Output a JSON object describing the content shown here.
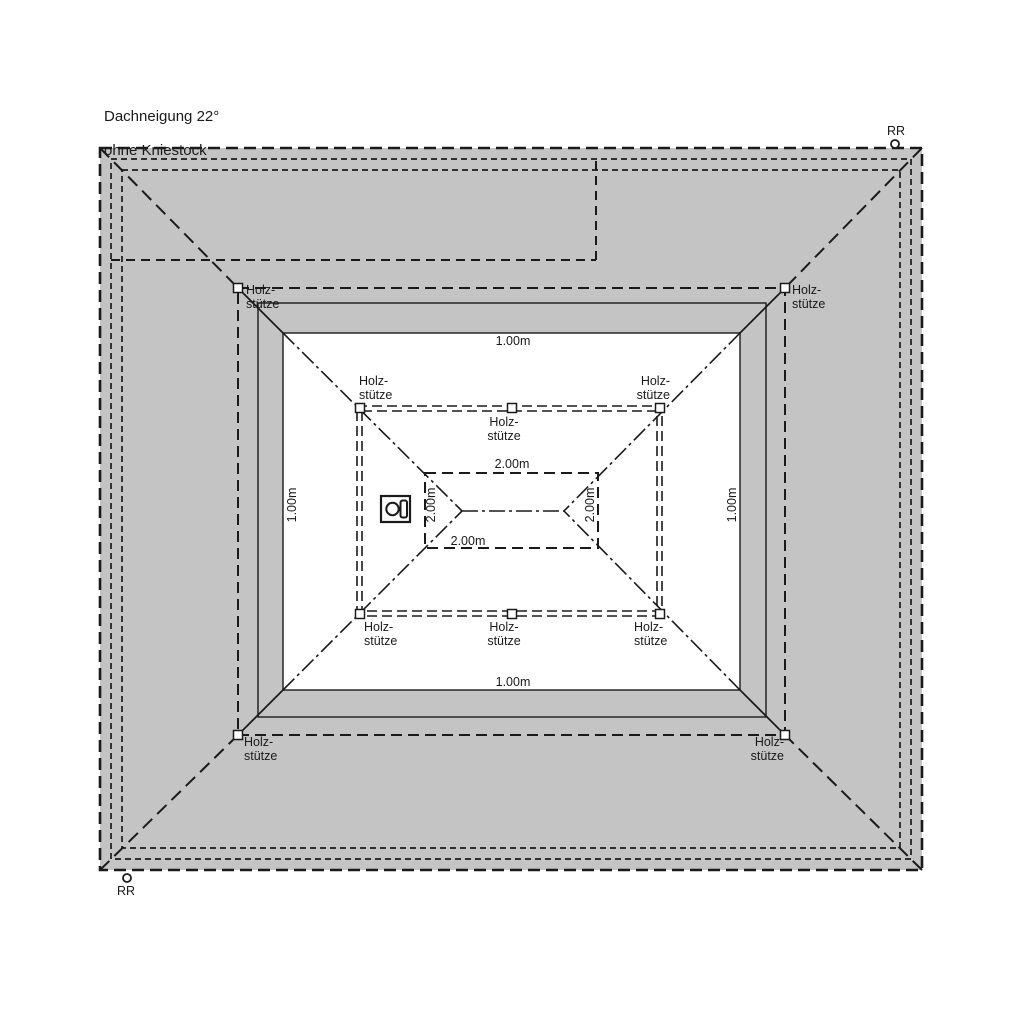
{
  "drawing": {
    "title_line1": "Dachneigung 22°",
    "title_line2": "ohne Kniestock",
    "roof_pitch": "22°",
    "support_label": "Holz-\nstütze",
    "downpipe_label": "RR",
    "dim_eave": "1.00m",
    "dim_inner": "2.00m",
    "colors": {
      "roof_fill": "#c4c4c4",
      "line": "#1a1a1a",
      "background": "#ffffff"
    },
    "icons": {
      "chimney": "chimney-icon",
      "downpipe": "downpipe-circle-icon",
      "support_post": "support-post-square"
    }
  }
}
